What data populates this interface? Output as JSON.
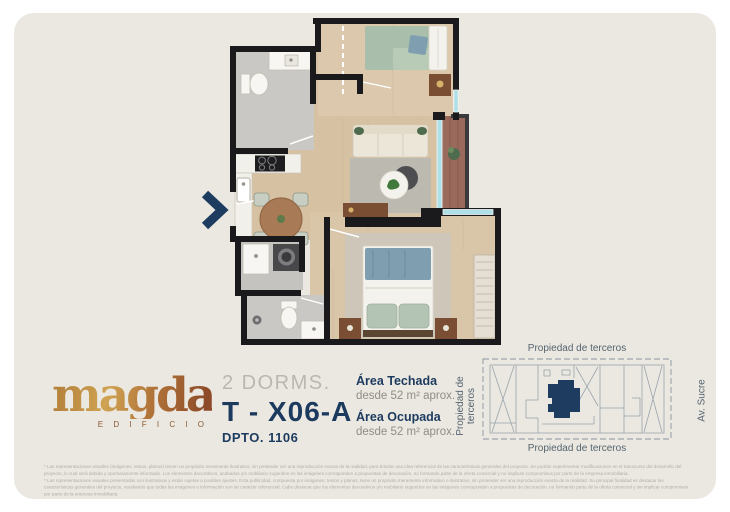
{
  "brand": {
    "name": "magda",
    "subtitle": "E D I F I C I O",
    "gold_start": "#cfa352",
    "gold_end": "#8d4a28"
  },
  "unit": {
    "dorms": "2 DORMS.",
    "code": "T - X06-A",
    "dpto": "DPTO. 1106"
  },
  "areas": {
    "techada_label": "Área Techada",
    "techada_value": "desde 52 m² aprox.",
    "ocupada_label": "Área Ocupada",
    "ocupada_value": "desde 52 m² aprox."
  },
  "site_map": {
    "top_label": "Propiedad de terceros",
    "bottom_label": "Propiedad de terceros",
    "left_label": "Propiedad de terceros",
    "right_label": "Av. Sucre",
    "highlight_color": "#1d3c60"
  },
  "floor_plan": {
    "entrance_marker": "chevron-right-icon",
    "colors": {
      "wall": "#1a1a1d",
      "wood_floor": "#d9c4a6",
      "tile_floor": "#c9c8c4",
      "balcony_wood": "#9a6a5d",
      "glass": "#aee0e8",
      "accent_navy": "#1c3a5e"
    }
  },
  "legal": {
    "p1": "* Las representaciones visuales (imágenes, textos, planos) tienen un propósito meramente ilustrativo, sin pretender ser una reproducción exacta de la realidad, para brindar una idea referencial de las características generales del proyecto. Se podrán experimentar modificaciones en el transcurso del desarrollo del proyecto, lo cual será debida y oportunamente informado. Los elementos decorativos, acabados y/o mobiliario sugeridos en las imágenes corresponden a propuestas de decoración, no formando parte de la oferta comercial y no implican compromisos por parte de la empresa inmobiliaria.",
    "p2": "* Las representaciones visuales presentadas son ilustrativas y están sujetas a posibles ajustes. Esta publicidad, compuesta por imágenes, textos y planos, tiene un propósito meramente informativo e ilustrativo, sin pretender ser una reproducción exacta de la realidad. Su principal finalidad es destacar las características generales del proyecto, resaltando que todas las imágenes e información son de carácter referencial. Cabe destacar que los elementos decorativos y/o mobiliario sugeridos en las imágenes corresponden a propuestas de decoración, no formando parte de la oferta comercial y sin implicar compromisos por parte de la empresa inmobiliaria."
  }
}
